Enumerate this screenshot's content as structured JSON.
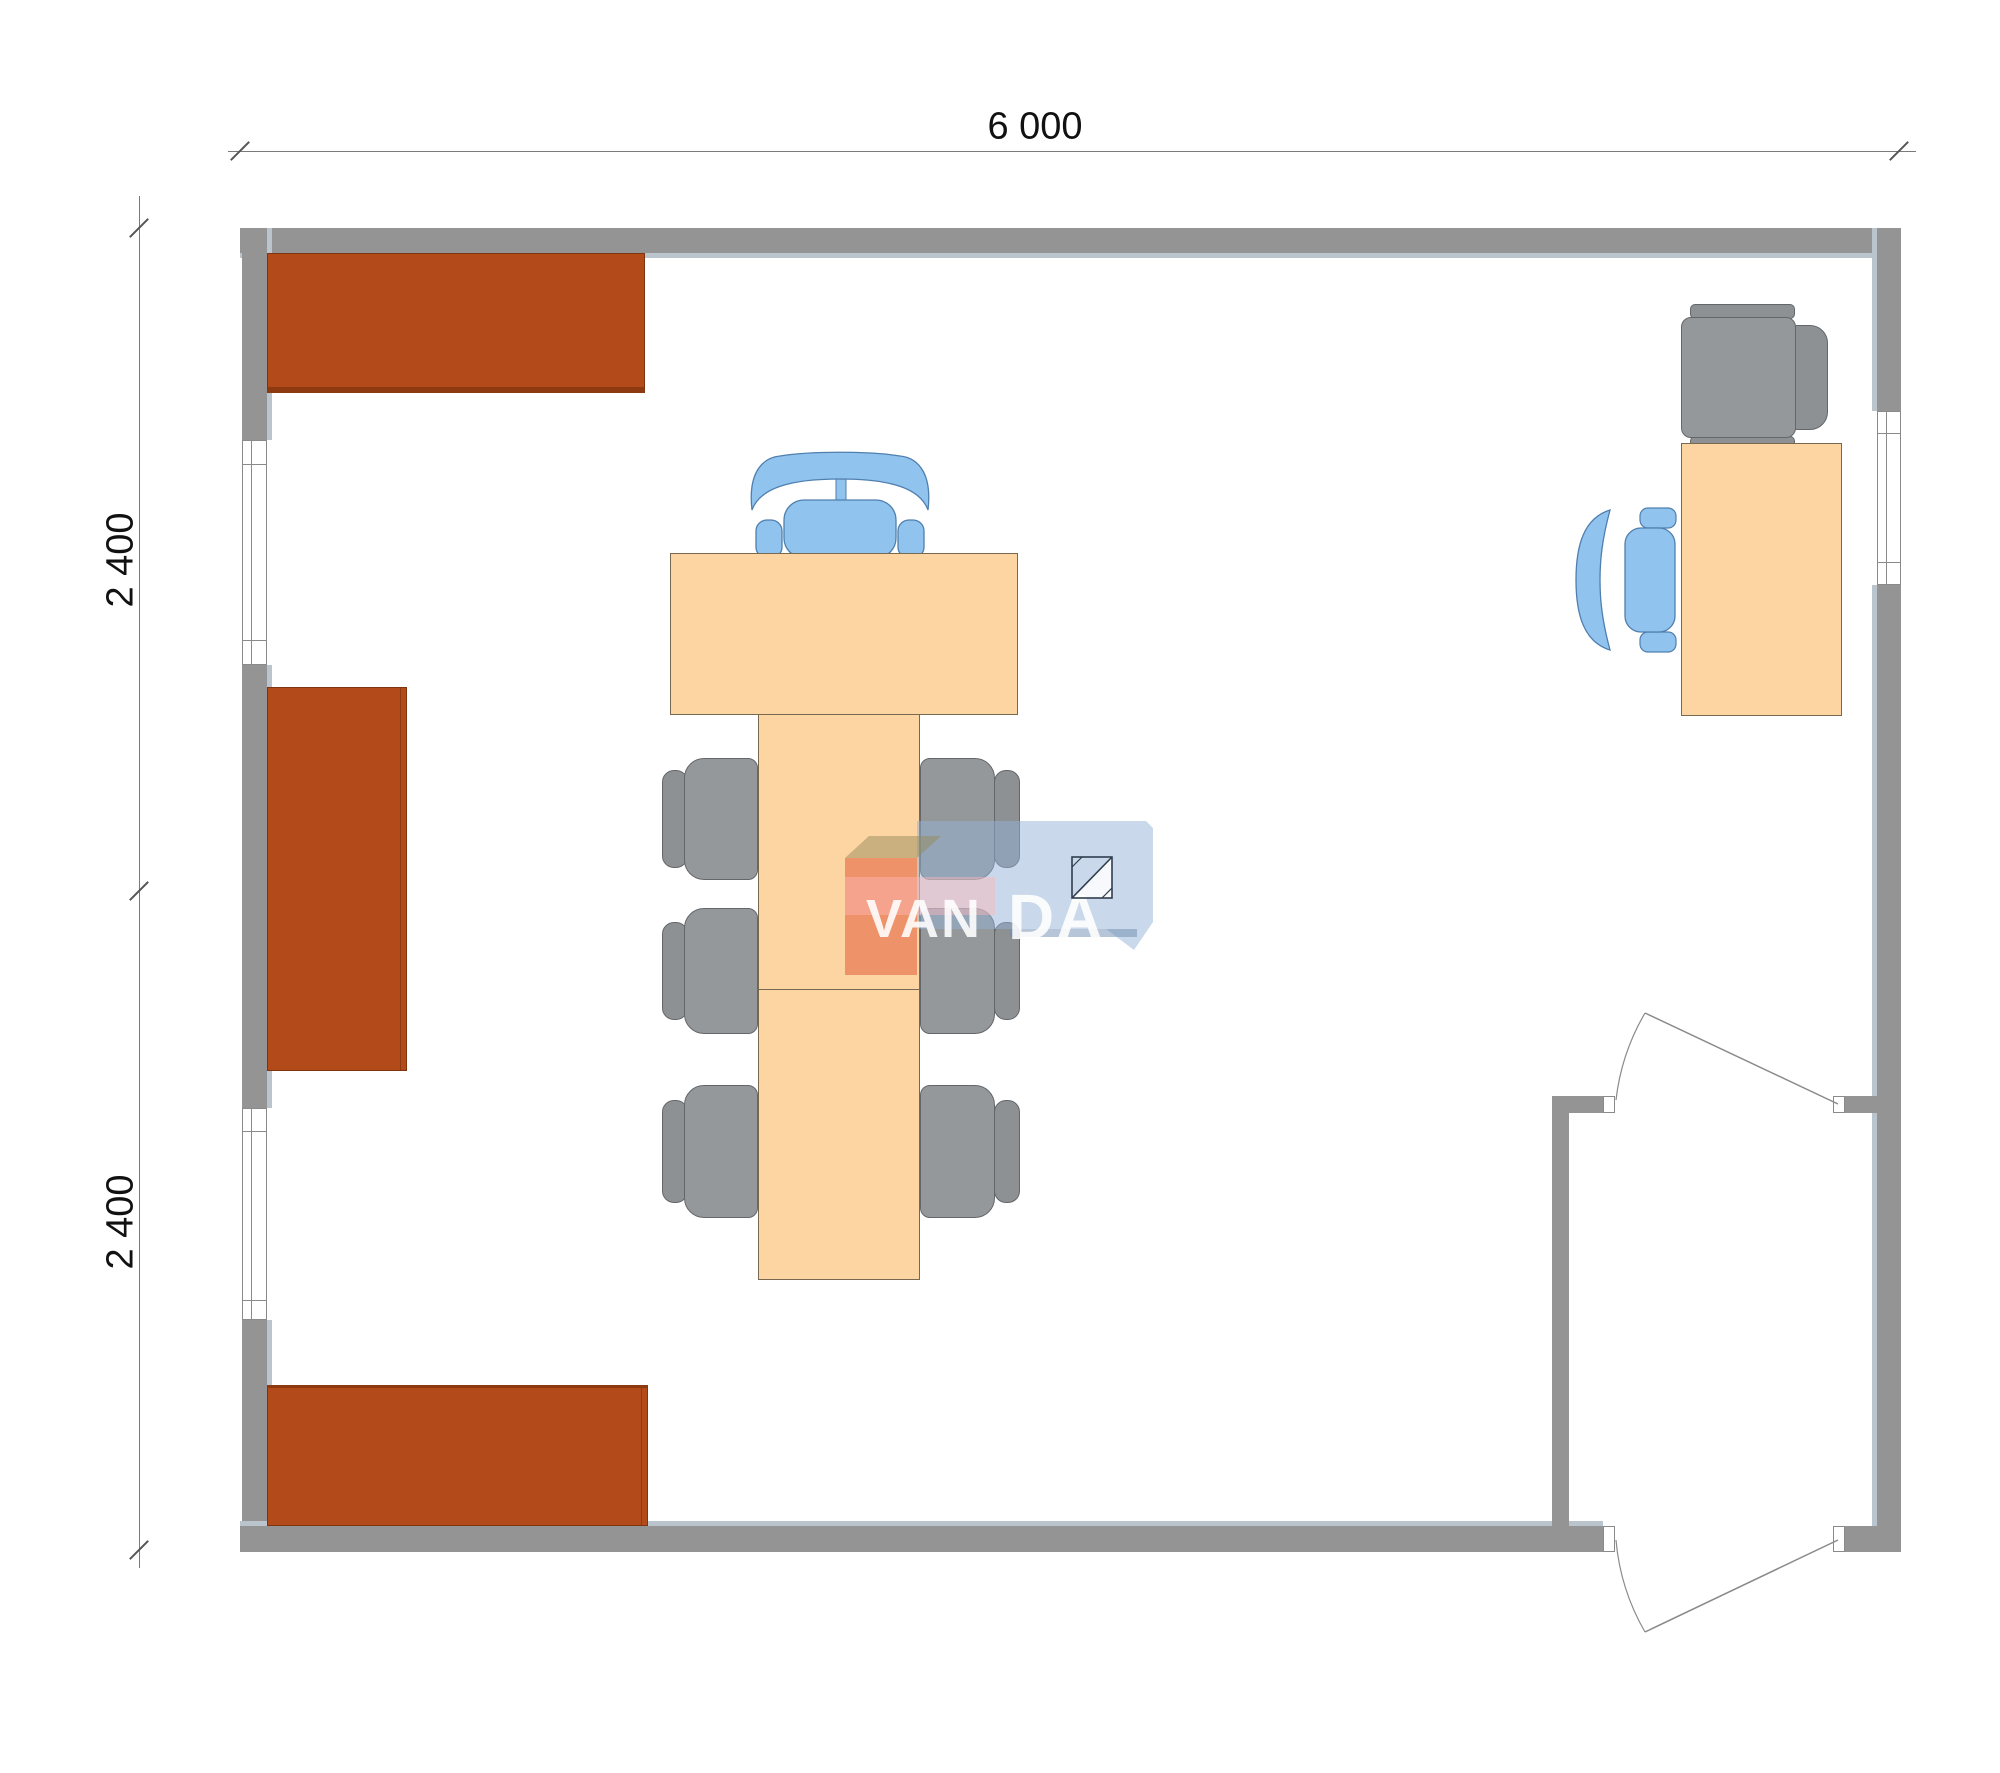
{
  "plan": {
    "dimensions": {
      "width_label": "6 000",
      "height_upper_label": "2 400",
      "height_lower_label": "2 400"
    },
    "logo": {
      "text": "VANDA",
      "text_part1": "VAN",
      "text_part2": "DA"
    },
    "inventory": {
      "wall_cabinets": 3,
      "windows": 3,
      "doors": 2,
      "conference_tables": 2,
      "conference_chairs_gray": 6,
      "executive_chair_blue": 1,
      "desks": 1,
      "desk_chair_blue": 1,
      "visitor_chair_gray": 1
    }
  },
  "colors": {
    "wall": "#949494",
    "wall-shadow": "#b9c4cc",
    "wall-line": "#6f6f6f",
    "cabinet": "#b24a19",
    "cabinet-border": "#7f3410",
    "cabinet-edge": "#8d3a10",
    "table": "#fcd5a2",
    "table-border": "#77694f",
    "chair-gray": "#94989b",
    "chair-gray-border": "#63676a",
    "chair-gray-dark": "#8d9194",
    "chair-blue": "#90c3ee",
    "chair-blue-border": "#4f7fae",
    "dim-line": "#7a7a7a",
    "text": "#111111",
    "window": "#ffffff",
    "window-border": "#8a8a8a",
    "logo-red": "rgba(222,80,48,0.5)",
    "logo-tan": "rgba(150,140,90,0.5)",
    "logo-blue": "rgba(148,177,213,0.5)",
    "logo-white": "rgba(255,255,255,0.88)"
  }
}
